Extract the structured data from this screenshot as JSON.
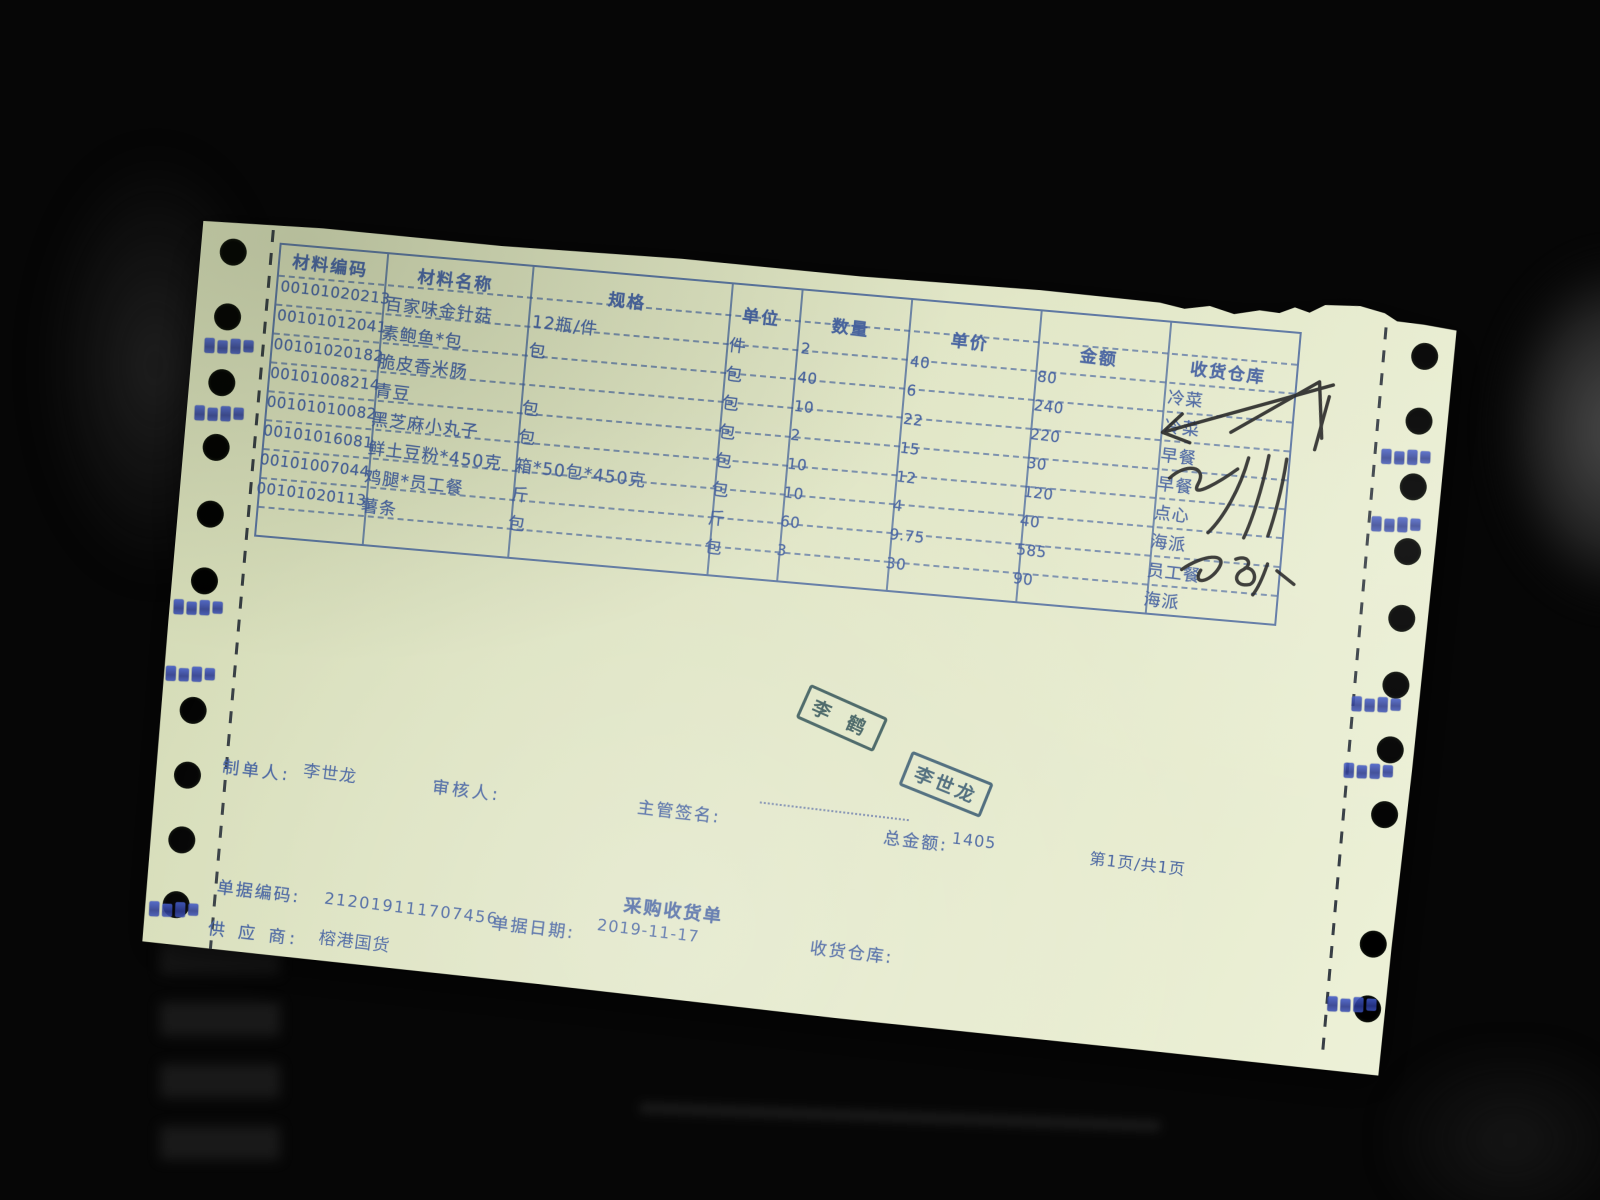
{
  "document": {
    "title": "采购收货单",
    "page_info": "第1页/共1页",
    "table": {
      "headers": [
        "材料编码",
        "材料名称",
        "规格",
        "单位",
        "数量",
        "单价",
        "金额",
        "收货仓库"
      ],
      "rows": [
        [
          "00101020213",
          "百家味金针菇",
          "12瓶/件",
          "件",
          "2",
          "40",
          "80",
          "冷菜"
        ],
        [
          "00101012041",
          "素鲍鱼*包",
          "包",
          "包",
          "40",
          "6",
          "240",
          "冷菜"
        ],
        [
          "00101020182",
          "脆皮香米肠",
          "",
          "包",
          "10",
          "22",
          "220",
          "早餐"
        ],
        [
          "00101008214",
          "青豆",
          "包",
          "包",
          "2",
          "15",
          "30",
          "早餐"
        ],
        [
          "00101010082",
          "黑芝麻小丸子",
          "包",
          "包",
          "10",
          "12",
          "120",
          "点心"
        ],
        [
          "00101016081",
          "鲜土豆粉*450克",
          "箱*50包*450克",
          "包",
          "10",
          "4",
          "40",
          "海派"
        ],
        [
          "00101007044",
          "鸡腿*员工餐",
          "斤",
          "斤",
          "60",
          "9.75",
          "585",
          "员工餐"
        ],
        [
          "00101020113",
          "薯条",
          "包",
          "包",
          "3",
          "30",
          "90",
          "海派"
        ]
      ]
    },
    "footer": {
      "maker_label": "制单人:",
      "maker_value": "李世龙",
      "reviewer_label": "审核人:",
      "supervisor_sign_label": "主管签名:",
      "total_label": "总金额:",
      "total_value": "1405",
      "doc_code_label": "单据编码:",
      "doc_code_value": "212019111707456",
      "doc_date_label": "单据日期:",
      "doc_date_value": "2019-11-17",
      "supplier_label": "供 应 商:",
      "supplier_value": "榕港国货",
      "receive_warehouse_label": "收货仓库:"
    },
    "stamps": [
      {
        "text": "李 鹤",
        "color": "#2a4d4f"
      },
      {
        "text": "李世龙",
        "color": "#33566b"
      }
    ],
    "colors": {
      "paper": "#dfe5c3",
      "print_ink": "#3f5c9d",
      "signature_ink": "#1a1a1a",
      "edge_smudge_blue": "#3a50bf"
    }
  }
}
